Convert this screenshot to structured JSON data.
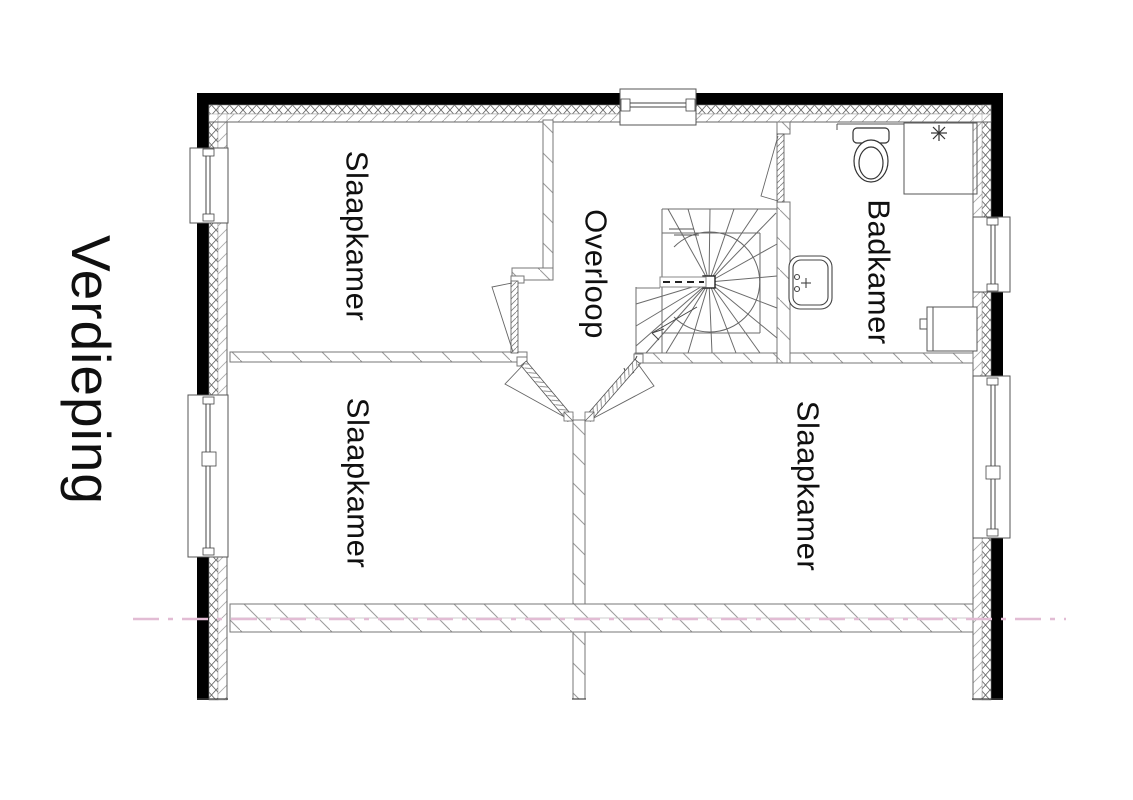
{
  "title": {
    "text": "Verdieping"
  },
  "rooms": [
    {
      "name": "slaapkamer-top-left",
      "label": "Slaapkamer"
    },
    {
      "name": "overloop",
      "label": "Overloop"
    },
    {
      "name": "badkamer",
      "label": "Badkamer"
    },
    {
      "name": "slaapkamer-bottom-left",
      "label": "Slaapkamer"
    },
    {
      "name": "slaapkamer-bottom-right",
      "label": "Slaapkamer"
    }
  ],
  "symbols": {
    "staircase": "winder-staircase-with-newel",
    "toilet": "toilet-top-view",
    "washbasin": "washbasin-top-view",
    "shower": "shower-head-asterisk",
    "radiator": "radiator",
    "windows": "framed-window-in-cavity-wall",
    "doors": "door-leaf-with-swing-triangle",
    "section_line": "dashed-height-section-line"
  },
  "colors": {
    "wall_black": "#000000",
    "line_dark": "#2b2b2b",
    "line_gray": "#777777",
    "hatch_gray": "#9a9a9a",
    "section_line_pink": "#e2bcd4",
    "background": "#ffffff"
  }
}
